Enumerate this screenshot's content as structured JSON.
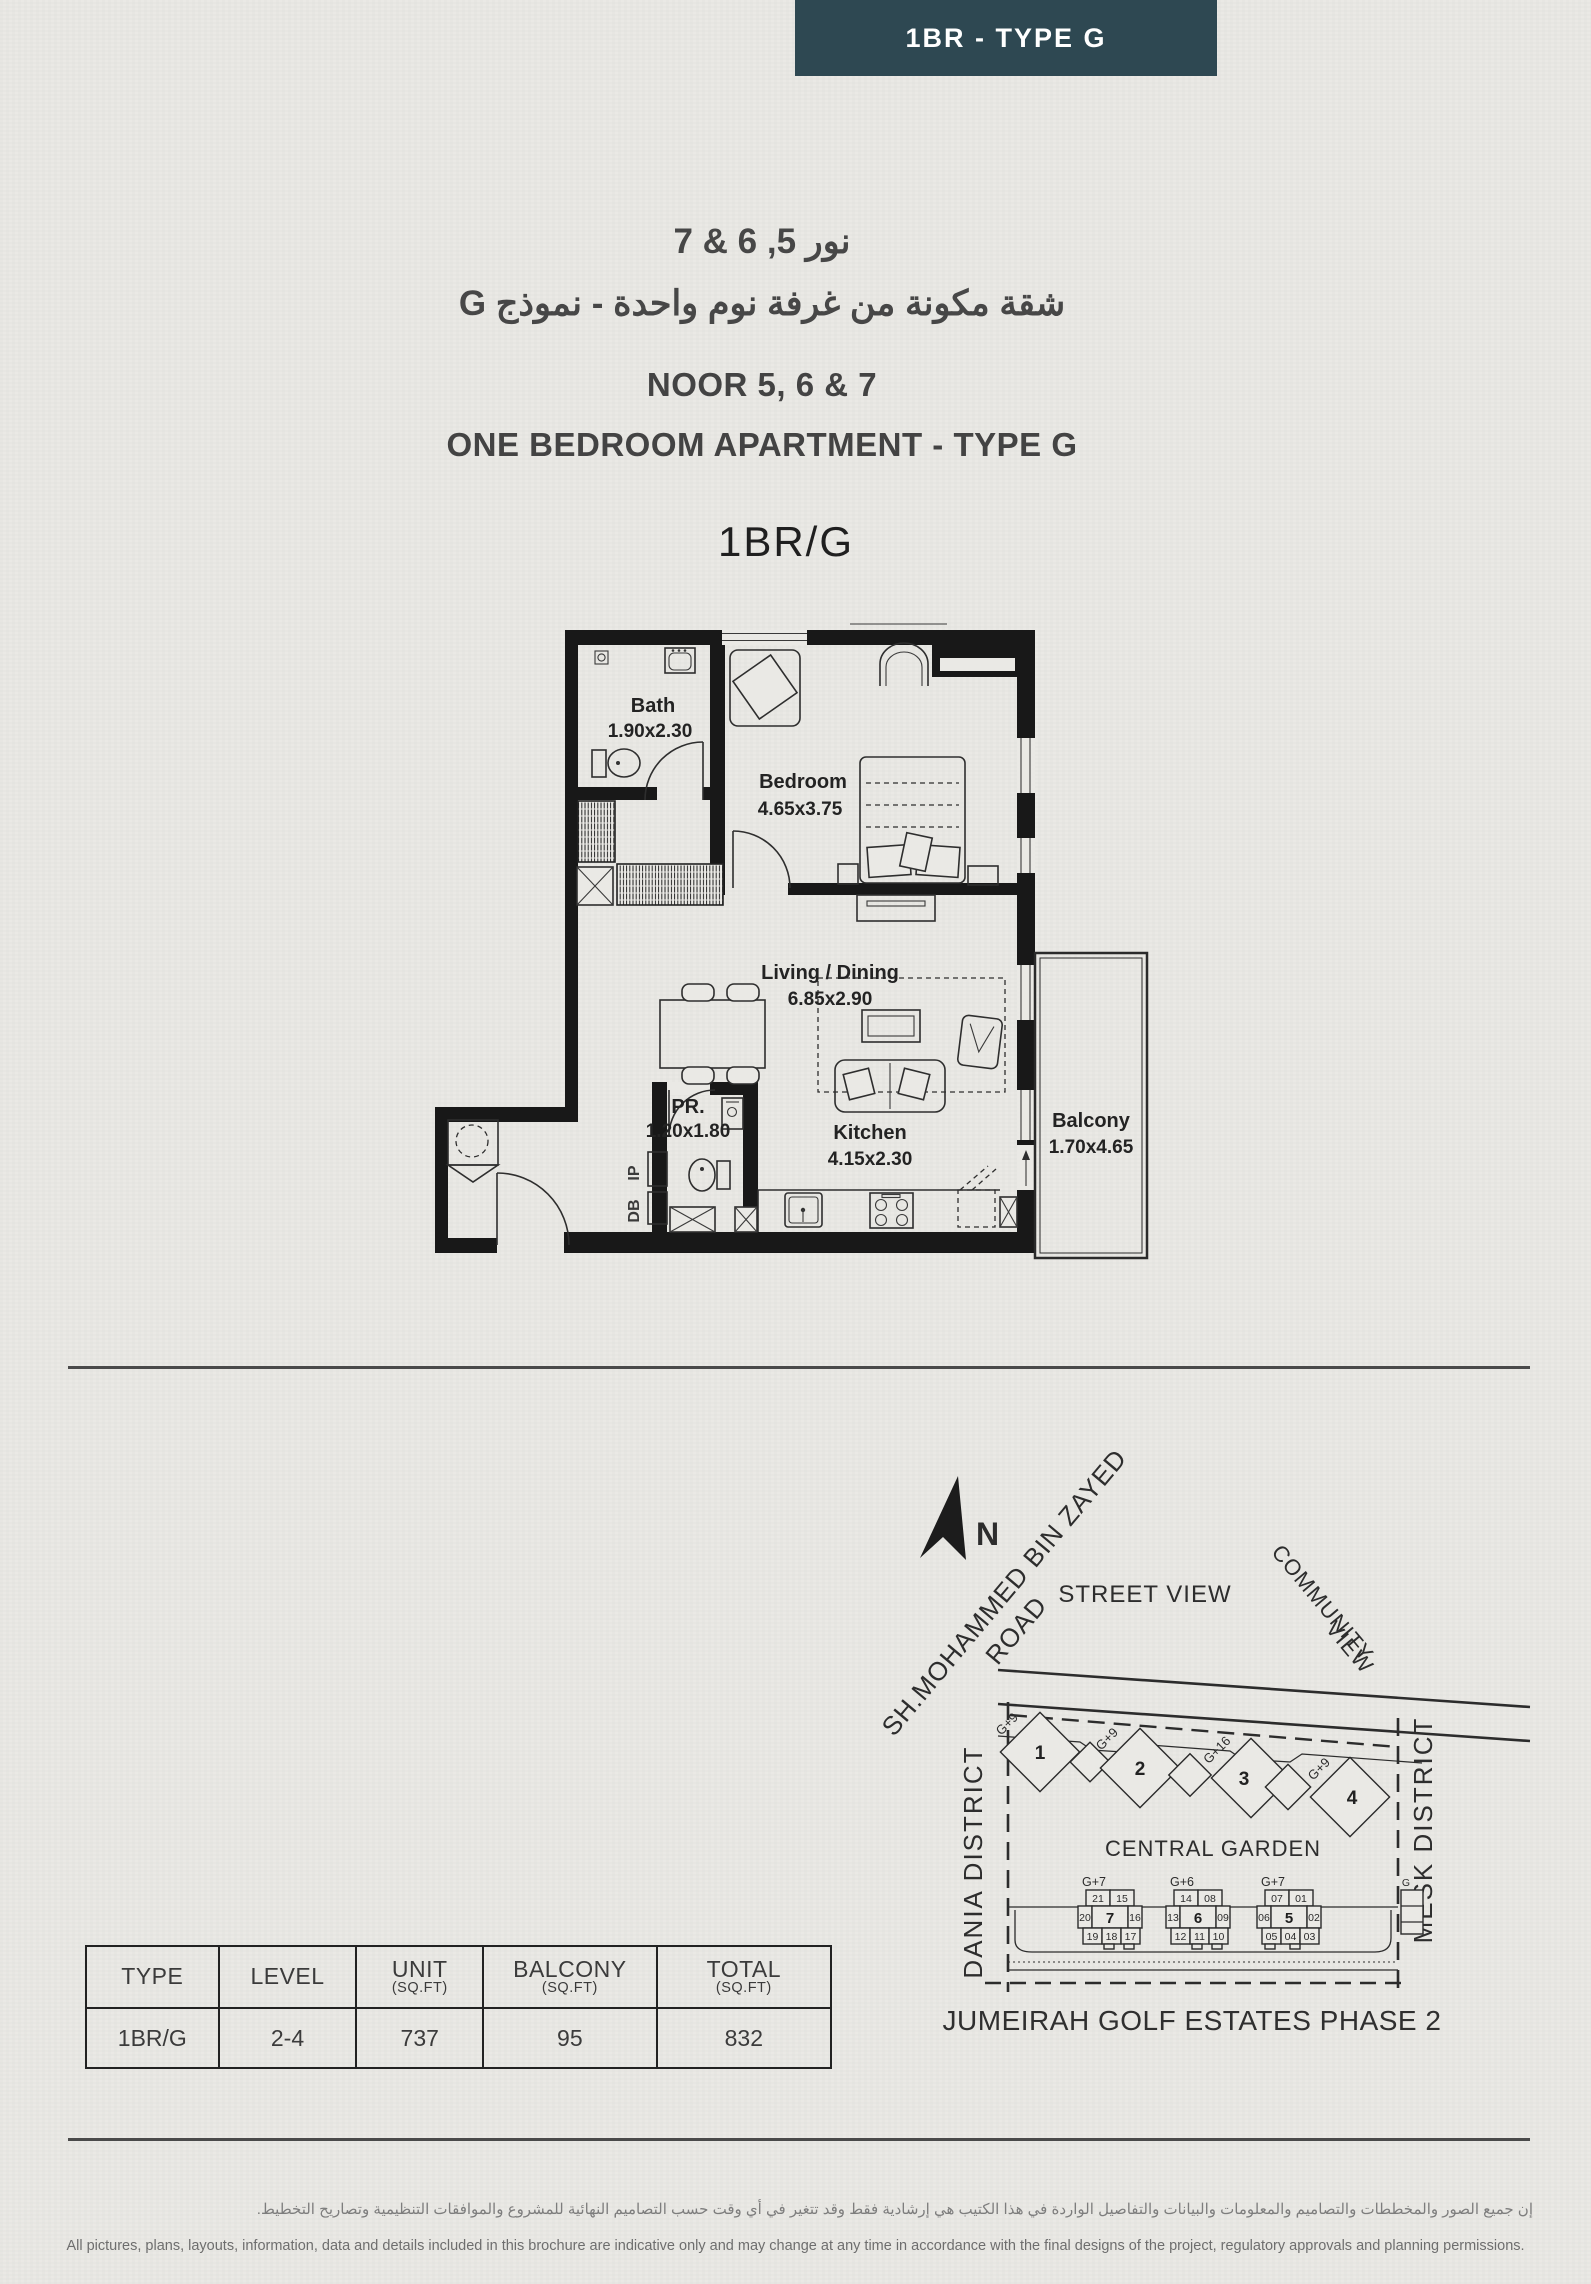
{
  "badge": {
    "label": "1BR - TYPE G"
  },
  "header": {
    "title_ar_line1": "نور 5, 6 & 7",
    "title_ar_line2": "شقة مكونة من غرفة نوم واحدة - نموذج G",
    "title_en_line1": "NOOR 5, 6 & 7",
    "title_en_line2": "ONE BEDROOM APARTMENT - TYPE G",
    "unit_code": "1BR/G"
  },
  "floor_plan": {
    "rooms": [
      {
        "name": "Bath",
        "dim": "1.90x2.30"
      },
      {
        "name": "Bedroom",
        "dim": "4.65x3.75"
      },
      {
        "name": "Living / Dining",
        "dim": "6.85x2.90"
      },
      {
        "name": "PR.",
        "dim": "1.20x1.80"
      },
      {
        "name": "Kitchen",
        "dim": "4.15x2.30"
      },
      {
        "name": "Balcony",
        "dim": "1.70x4.65"
      }
    ],
    "annotations": {
      "db": "DB",
      "ip": "IP"
    }
  },
  "site_map": {
    "north_label": "N",
    "road_label_line1": "SH.MOHAMMED BIN ZAYED",
    "road_label_line2": "ROAD",
    "street_view": "STREET VIEW",
    "community_view_line1": "COMMUNITY",
    "community_view_line2": "VIEW",
    "dania_district": "DANIA DISTRICT",
    "mesk_district": "MESK DISTRICT",
    "central_garden": "CENTRAL GARDEN",
    "phase_label": "JUMEIRAH GOLF ESTATES PHASE 2",
    "partial_building_label": "G",
    "towers": [
      {
        "number": "1",
        "height": "G+9"
      },
      {
        "number": "2",
        "height": "G+9"
      },
      {
        "number": "3",
        "height": "G+16"
      },
      {
        "number": "4",
        "height": "G+9"
      }
    ],
    "buildings": [
      {
        "label": "G+7",
        "number": "7",
        "top": [
          "21",
          "15"
        ],
        "mid": [
          "20",
          "16"
        ],
        "bottom": [
          "19",
          "18",
          "17"
        ],
        "highlighted_unit": "17"
      },
      {
        "label": "G+6",
        "number": "6",
        "top": [
          "14",
          "08"
        ],
        "mid": [
          "13",
          "09"
        ],
        "bottom": [
          "12",
          "11",
          "10"
        ],
        "highlighted_unit": "10"
      },
      {
        "label": "G+7",
        "number": "5",
        "top": [
          "07",
          "01"
        ],
        "mid": [
          "06",
          "02"
        ],
        "bottom": [
          "05",
          "04",
          "03"
        ],
        "highlighted_unit": "05"
      }
    ],
    "highlight_color": "#837c8c"
  },
  "table": {
    "headers": [
      {
        "label": "TYPE",
        "sub": ""
      },
      {
        "label": "LEVEL",
        "sub": ""
      },
      {
        "label": "UNIT",
        "sub": "(SQ.FT)"
      },
      {
        "label": "BALCONY",
        "sub": "(SQ.FT)"
      },
      {
        "label": "TOTAL",
        "sub": "(SQ.FT)"
      }
    ],
    "row": {
      "type": "1BR/G",
      "level": "2-4",
      "unit": "737",
      "balcony": "95",
      "total": "832"
    }
  },
  "disclaimer": {
    "ar": "إن جميع الصور والمخططات والتصاميم والمعلومات والبيانات والتفاصيل الواردة في هذا الكتيب هي إرشادية فقط وقد تتغير في أي وقت حسب التصاميم النهائية للمشروع والموافقات التنظيمية وتصاريح التخطيط.",
    "en": "All pictures, plans, layouts, information, data and details included in this brochure are indicative only and may change at any time in accordance with the final designs of the project, regulatory approvals and planning permissions."
  },
  "colors": {
    "badge": "#2e4852",
    "paper": "#eae9e5",
    "highlight": "#837c8c"
  }
}
